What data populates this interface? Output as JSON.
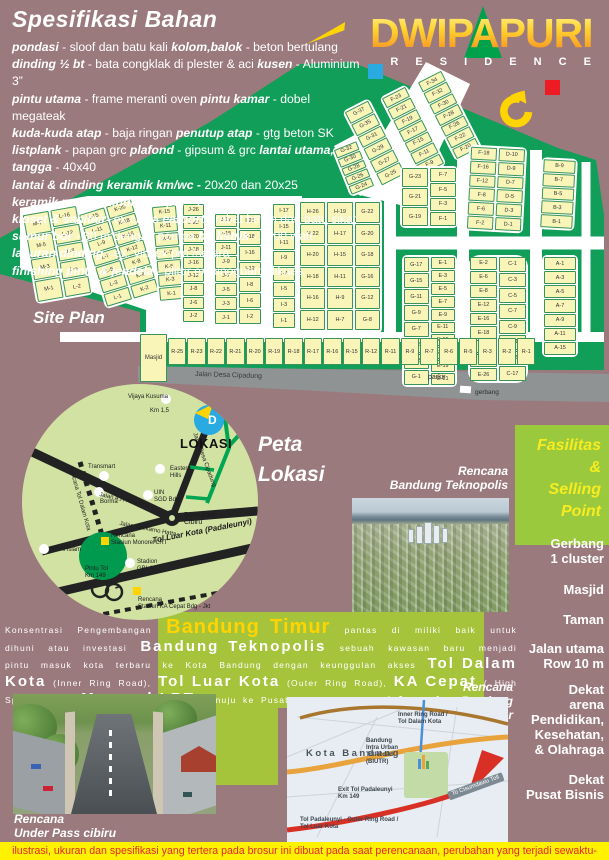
{
  "brand": {
    "name": "DWIPAPURI",
    "residence": "R E S I D E N C E"
  },
  "colors": {
    "mauve": "#9b7a7e",
    "siteplan_green": "#119e58",
    "lot_yellow": "#f9f5b8",
    "band_green": "#a5c43b",
    "circle_green": "#d2e2a2",
    "accent_yellow": "#ffd400",
    "blue_square": "#29abe2",
    "red_square": "#ed1c24",
    "disclaimer_bg": "#fff200",
    "disclaimer_text": "#e5252a"
  },
  "spec": {
    "title": "Spesifikasi Bahan",
    "lines": [
      [
        [
          "pondasi",
          1
        ],
        [
          " - sloof dan batu kali ",
          0
        ],
        [
          "kolom,balok",
          1
        ],
        [
          " - beton bertulang",
          0
        ]
      ],
      [
        [
          "dinding ½ bt",
          1
        ],
        [
          " - bata congklak di plester & aci ",
          0
        ],
        [
          "kusen",
          1
        ],
        [
          " - Aluminium 3”",
          0
        ]
      ],
      [
        [
          "pintu utama",
          1
        ],
        [
          " - frame meranti  oven ",
          0
        ],
        [
          "pintu kamar",
          1
        ],
        [
          " - dobel megateak",
          0
        ]
      ],
      [
        [
          "kuda-kuda atap",
          1
        ],
        [
          " - baja ringan ",
          0
        ],
        [
          "penutup atap",
          1
        ],
        [
          " - gtg beton SK",
          0
        ]
      ],
      [
        [
          "listplank",
          1
        ],
        [
          " - papan grc ",
          0
        ],
        [
          "plafond",
          1
        ],
        [
          " - gipsum & grc ",
          0
        ],
        [
          "lantai utama, tangga",
          1
        ],
        [
          " - 40x40",
          0
        ]
      ],
      [
        [
          "lantai & dinding keramik km/wc -",
          1
        ],
        [
          " 20x20 dan 20x25",
          0
        ]
      ],
      [
        [
          "keramik meja & dinding dapur",
          1
        ],
        [
          " - 20x20",
          0
        ]
      ],
      [
        [
          "kloset & sanitair",
          1
        ],
        [
          "- ex china ",
          0
        ],
        [
          "carport",
          1
        ],
        [
          " - rabat beton dan batu sikat",
          0
        ]
      ],
      [
        [
          "sumur bor",
          1
        ],
        [
          " - 30 m dengan pompa ",
          0
        ],
        [
          "bp listrik",
          1
        ],
        [
          " - 1300 watt",
          0
        ]
      ],
      [
        [
          "laburan dinding",
          1
        ],
        [
          " - ex. vinilex pro /setara",
          0
        ]
      ],
      [
        [
          "finishing pintu & jendela",
          1
        ],
        [
          " - plitur ex.pinoguard dikuas",
          0
        ]
      ]
    ]
  },
  "site_plan": {
    "title": "Site Plan",
    "masjid_label": "Masjid",
    "parkir_label": "parkir",
    "gerbang_label": "gerbang",
    "road_label": "Jalan Desa Cipadung",
    "r_row": [
      "R-25",
      "R-23",
      "R-22",
      "R-21",
      "R-20",
      "R-19",
      "R-18",
      "R-17",
      "R-16",
      "R-15",
      "R-12",
      "R-11",
      "R-9",
      "R-7",
      "R-6",
      "R-5",
      "R-3",
      "R-2",
      "R-1"
    ],
    "blocks": [
      {
        "x": 28,
        "y": 208,
        "w": 58,
        "h": 92,
        "rot": -10,
        "cols": [
          [
            "M-7",
            "M-5",
            "M-3",
            "M-1"
          ],
          [
            "L-16",
            "L-12",
            "L-8",
            "L-4",
            "L-2"
          ]
        ]
      },
      {
        "x": 90,
        "y": 203,
        "w": 58,
        "h": 100,
        "rot": -17,
        "cols": [
          [
            "L-15",
            "L-11",
            "L-9",
            "L-7",
            "L-5",
            "L-3",
            "L-1"
          ],
          [
            "K-20",
            "K-18",
            "K-16",
            "K-12",
            "K-8",
            "K-4",
            "K-2"
          ]
        ]
      },
      {
        "x": 154,
        "y": 204,
        "w": 28,
        "h": 98,
        "rot": -5,
        "cols": [
          [
            "K-15",
            "K-11",
            "K-9",
            "K-7",
            "K-5",
            "K-3",
            "K-1"
          ]
        ]
      },
      {
        "x": 181,
        "y": 202,
        "w": 25,
        "h": 122,
        "rot": 0,
        "cols": [
          [
            "J-26",
            "J-22",
            "J-20",
            "J-18",
            "J-16",
            "J-12",
            "J-8",
            "J-6",
            "J-2"
          ]
        ]
      },
      {
        "x": 213,
        "y": 212,
        "w": 50,
        "h": 114,
        "rot": 0,
        "r": 1,
        "cols": [
          [
            "J-17",
            "J-15",
            "J-11",
            "J-9",
            "J-7",
            "J-5",
            "J-3",
            "J-1"
          ],
          [
            "I-28",
            "I-18",
            "I-16",
            "I-12",
            "I-8",
            "I-6",
            "I-2"
          ]
        ]
      },
      {
        "x": 271,
        "y": 202,
        "w": 26,
        "h": 128,
        "rot": 0,
        "cols": [
          [
            "I-17",
            "I-15",
            "I-11",
            "I-9",
            "I-7",
            "I-5",
            "I-3",
            "I-1"
          ]
        ]
      },
      {
        "x": 298,
        "y": 200,
        "w": 84,
        "h": 132,
        "rot": 0,
        "cols": [
          [
            "H-26",
            "H-22",
            "H-20",
            "H-18",
            "H-16",
            "H-12"
          ],
          [
            "H-19",
            "H-17",
            "H-15",
            "H-11",
            "H-9",
            "H-7"
          ],
          [
            "G-22",
            "G-20",
            "G-18",
            "G-16",
            "G-12",
            "G-8"
          ]
        ]
      },
      {
        "x": 360,
        "y": 100,
        "w": 30,
        "h": 86,
        "rot": -27,
        "cols": [
          [
            "G-37",
            "G-35",
            "G-31",
            "G-29",
            "G-27",
            "G-25"
          ]
        ]
      },
      {
        "x": 398,
        "y": 86,
        "w": 30,
        "h": 90,
        "rot": -27,
        "cols": [
          [
            "F-23",
            "F-21",
            "F-19",
            "F-17",
            "F-15",
            "F-11",
            "F-9"
          ]
        ]
      },
      {
        "x": 434,
        "y": 70,
        "w": 30,
        "h": 90,
        "rot": -27,
        "cols": [
          [
            "F-34",
            "F-32",
            "F-30",
            "F-28",
            "F-26",
            "F-22",
            "F-20"
          ]
        ]
      },
      {
        "x": 340,
        "y": 142,
        "w": 28,
        "h": 52,
        "rot": -22,
        "cols": [
          [
            "G-32",
            "G-30",
            "G-28",
            "G-26",
            "G-24"
          ]
        ]
      },
      {
        "x": 467,
        "y": 146,
        "w": 58,
        "h": 86,
        "rot": 3,
        "cols": [
          [
            "F-18",
            "F-16",
            "F-12",
            "F-8",
            "F-6",
            "F-2"
          ],
          [
            "D-10",
            "D-9",
            "D-7",
            "D-5",
            "D-3",
            "D-1"
          ]
        ]
      },
      {
        "x": 540,
        "y": 158,
        "w": 36,
        "h": 72,
        "rot": 3,
        "cols": [
          [
            "B-9",
            "B-7",
            "B-5",
            "B-3",
            "B-1"
          ]
        ]
      },
      {
        "x": 400,
        "y": 166,
        "w": 58,
        "h": 62,
        "rot": 0,
        "cols": [
          [
            "G-23",
            "G-21",
            "G-19"
          ],
          [
            "F-7",
            "F-5",
            "F-3",
            "F-1"
          ]
        ]
      },
      {
        "x": 402,
        "y": 255,
        "w": 55,
        "h": 132,
        "rot": 0,
        "cols": [
          [
            "G-17",
            "G-15",
            "G-11",
            "G-9",
            "G-7",
            "G-5",
            "G-3",
            "G-1"
          ],
          [
            "E-1",
            "E-3",
            "E-5",
            "E-7",
            "E-9",
            "E-11",
            "E-15",
            "E-17",
            "E-19",
            "E-21"
          ]
        ]
      },
      {
        "x": 468,
        "y": 255,
        "w": 60,
        "h": 128,
        "rot": 0,
        "r": 1,
        "cols": [
          [
            "E-2",
            "E-6",
            "E-8",
            "E-12",
            "E-16",
            "E-18",
            "E-20",
            "E-22",
            "E-26"
          ],
          [
            "C-1",
            "C-3",
            "C-5",
            "C-7",
            "C-9",
            "C-11",
            "C-15",
            "C-17"
          ]
        ]
      },
      {
        "x": 542,
        "y": 255,
        "w": 36,
        "h": 102,
        "rot": 0,
        "cols": [
          [
            "A-1",
            "A-3",
            "A-5",
            "A-7",
            "A-9",
            "A-11",
            "A-15"
          ]
        ]
      }
    ]
  },
  "peta": {
    "title": "Peta\nLokasi",
    "lokasi_label": "LOKASI",
    "marker_letter": "D",
    "labels": [
      {
        "t": "Vijaya Kusuma",
        "x": 128,
        "y": 394
      },
      {
        "t": "Km 1,5",
        "x": 150,
        "y": 408
      },
      {
        "t": "Transmart",
        "x": 88,
        "y": 464
      },
      {
        "t": "Borma",
        "x": 100,
        "y": 499
      },
      {
        "t": "Eastern\nHills",
        "x": 170,
        "y": 466
      },
      {
        "t": "UIN\nSGD Bdg",
        "x": 154,
        "y": 490
      },
      {
        "t": "Bundaran\nCibiru",
        "x": 184,
        "y": 513,
        "cls": "pl-md"
      },
      {
        "t": "Jalan Desa Cipadung",
        "x": 197,
        "y": 432,
        "rot": 70
      },
      {
        "t": "Jalan A.H Nasution",
        "x": 100,
        "y": 492,
        "rot": 13
      },
      {
        "t": "Jalan Soekarno Hatta",
        "x": 120,
        "y": 521,
        "rot": 11
      },
      {
        "t": "Rencana Tol Dalam Kota",
        "x": 73,
        "y": 466,
        "rot": 74
      },
      {
        "t": "Tol Luar Kota (Padaleunyi)",
        "x": 152,
        "y": 538,
        "rot": -11,
        "cls": "pl-bold"
      },
      {
        "t": "Rencana\nStasiun Monorel LRT",
        "x": 111,
        "y": 533
      },
      {
        "t": "RS Al Islam",
        "x": 50,
        "y": 547
      },
      {
        "t": "Stadion\nGBLA",
        "x": 137,
        "y": 559
      },
      {
        "t": "Pintu Tol\nKm 149",
        "x": 85,
        "y": 566
      },
      {
        "t": "Rencana\nStasiun KA Cepat Bdg - Jkt",
        "x": 138,
        "y": 597
      }
    ],
    "dots": [
      [
        166,
        399
      ],
      [
        104,
        476
      ],
      [
        99,
        492
      ],
      [
        160,
        469
      ],
      [
        148,
        495
      ],
      [
        44,
        549
      ],
      [
        130,
        563
      ]
    ],
    "yellow_squares": [
      [
        101,
        537
      ],
      [
        133,
        587
      ]
    ]
  },
  "fasilitas": {
    "title": "Fasilitas\n&\nSelling\nPoint",
    "items": [
      {
        "t": "Gerbang\n1 cluster",
        "y": 536
      },
      {
        "t": "Masjid",
        "y": 582
      },
      {
        "t": "Taman",
        "y": 612
      },
      {
        "t": "Jalan utama\nRow 10 m",
        "y": 641
      },
      {
        "t": "Dekat\narena\nPendidikan,\nKesehatan,\n& Olahraga",
        "y": 682
      },
      {
        "t": "Dekat\nPusat Bisnis",
        "y": 772
      }
    ]
  },
  "captions": {
    "teknopolis": "Rencana\nBandung Teknopolis",
    "infrastruktur": "Rencana\nInfrastruktur Bandung Timur",
    "underpass": "Rencana\nUnder Pass cibiru"
  },
  "paragraph": {
    "segments": [
      {
        "t": "Konsentrasi Pengembangan ",
        "c": "sm"
      },
      {
        "t": "Bandung Timur",
        "c": "xl"
      },
      {
        "t": " pantas di miliki baik untuk dihuni atau investasi ",
        "c": "sm"
      },
      {
        "t": "Bandung Teknopolis",
        "c": "lg"
      },
      {
        "t": " sebuah kawasan baru menjadi pintu masuk kota terbaru ke Kota Bandung dengan keunggulan akses ",
        "c": "sm"
      },
      {
        "t": "Tol Dalam Kota",
        "c": "lg"
      },
      {
        "t": " (Inner Ring Road), ",
        "c": "sm2"
      },
      {
        "t": "Tol Luar Kota",
        "c": "lg"
      },
      {
        "t": " (Outer Ring Road), ",
        "c": "sm2"
      },
      {
        "t": "KA Cepat",
        "c": "lg"
      },
      {
        "t": " ( High Speed Train), ",
        "c": "sm2"
      },
      {
        "t": "Monorel LRT",
        "c": "lg"
      },
      {
        "t": " menuju ke Pusat Kota Bandung",
        "c": "sm2"
      }
    ]
  },
  "map_photo": {
    "labels": [
      {
        "t": "Inner Ring Road /\nTol Dalam Kota",
        "x": 398,
        "y": 712,
        "cls": "mp-b"
      },
      {
        "t": "Bandung\nIntra Urban\nToll Road\n(BIUTR)",
        "x": 366,
        "y": 738,
        "cls": "mp-b"
      },
      {
        "t": "Kota Bandung",
        "x": 306,
        "y": 750,
        "cls": "mp-city"
      },
      {
        "t": "Exit Tol Padaleunyi\nKm 149",
        "x": 338,
        "y": 787,
        "cls": "mp-b"
      },
      {
        "t": "Tol Padaleunyi - Outer Ring Road /\nTol Luar Kota",
        "x": 300,
        "y": 817,
        "cls": "mp-b"
      },
      {
        "t": "To Cisumdawu Toll",
        "x": 447,
        "y": 792,
        "rot": -20,
        "cls": "mp-arrowlbl"
      }
    ]
  },
  "disclaimer": "ilustrasi, ukuran  dan spesifikasi yang tertera pada brosur ini dibuat pada saat perencanaan, perubahan yang terjadi sewaktu-waktu merupakan hak penuh developer"
}
